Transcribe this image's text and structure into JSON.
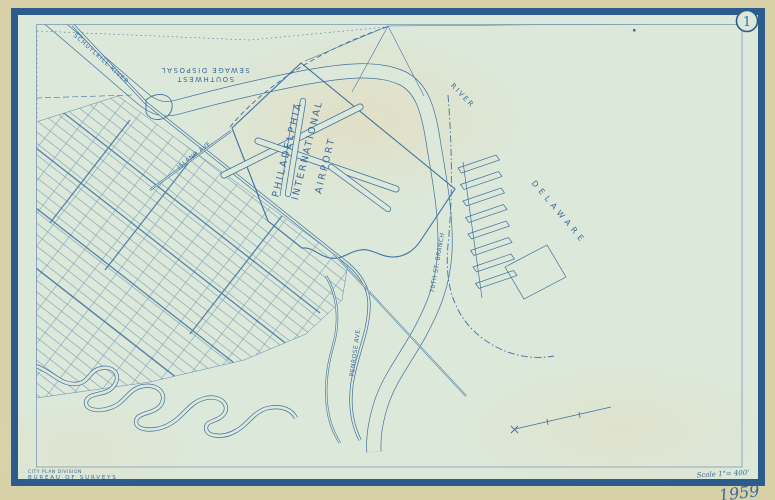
{
  "map": {
    "plate_number": "1",
    "sheet_refs": {
      "left": "2",
      "top": "7"
    },
    "year": "1959",
    "scale_note": "Scale 1\"= 400'",
    "credits": {
      "line1": "CITY PLAN DIVISION",
      "line2": "BUREAU OF SURVEYS"
    },
    "labels": {
      "airport_line1": "PHILADELPHIA",
      "airport_line2": "INTERNATIONAL",
      "airport_line3": "AIRPORT",
      "delaware": "DELAWARE",
      "river": "RIVER",
      "schuylkill": "SCHUYLKILL RIVER",
      "railroad": "70TH ST. BRANCH",
      "sewage_line1": "SOUTHWEST",
      "sewage_line2": "SEWAGE DISPOSAL",
      "island_ave": "ISLAND AVE.",
      "penrose": "PENROSE AVE."
    },
    "colors": {
      "ink": "#41719f",
      "frame": "#2c5c8c",
      "paper_outer": "#d8d1a8",
      "paper_inner": "#dce8d9",
      "text": "#3a6b9c"
    }
  }
}
